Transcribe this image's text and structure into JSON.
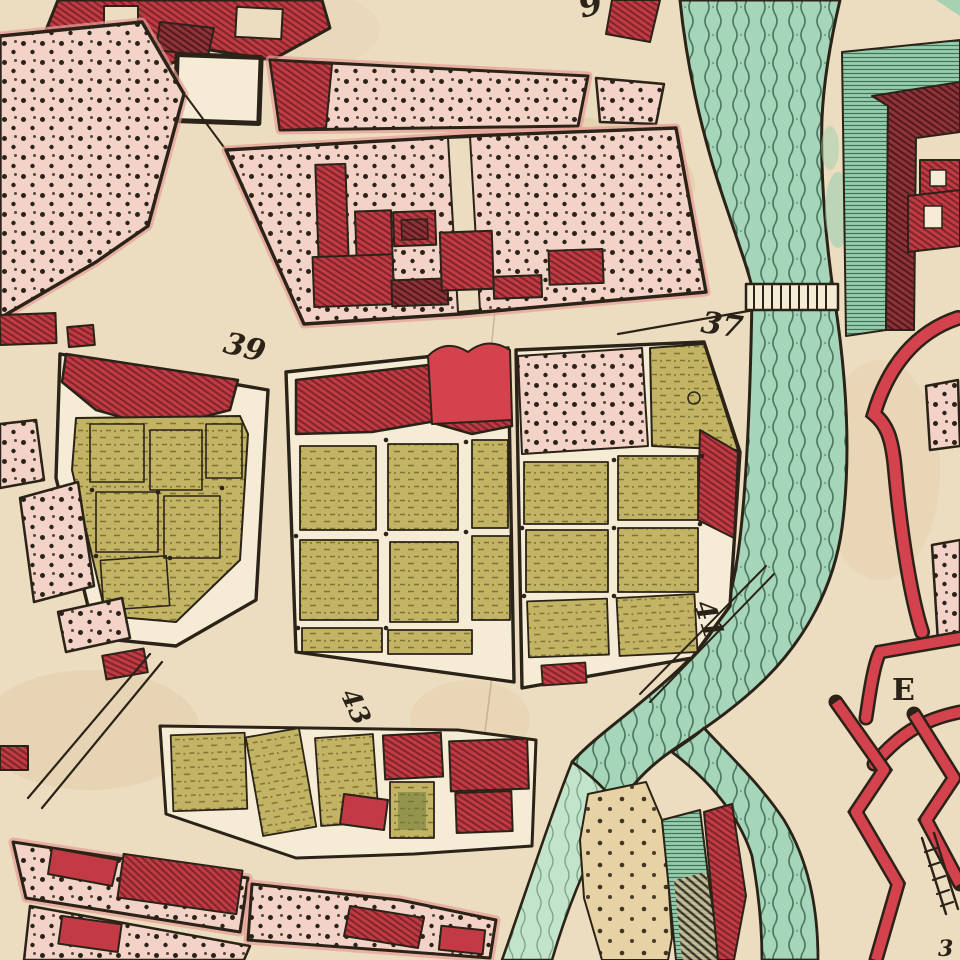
{
  "map": {
    "labels": {
      "block_39": "39",
      "block_37": "37",
      "block_41": "41",
      "block_43": "43",
      "ravelin_e": "E",
      "top_edge_partial": "9",
      "corner_partial": "3"
    },
    "palette": {
      "paper": "#ecdcc0",
      "paperLight": "#f6ecd6",
      "sand": "#e6d2a4",
      "ink": "#2b2317",
      "red": "#c23a43",
      "redBright": "#d4424e",
      "redDark": "#8c3438",
      "redLine": "#7e262c",
      "pink": "#f3d2c8",
      "pinkDeep": "#e79d97",
      "olive": "#c3b465",
      "oliveDark": "#7c7434",
      "river": "#a5d6ba",
      "riverPale": "#c2e4c9",
      "riverDark": "#2f5a45",
      "glacis": "#96cfae",
      "glacisLine": "#2f5c44"
    }
  }
}
